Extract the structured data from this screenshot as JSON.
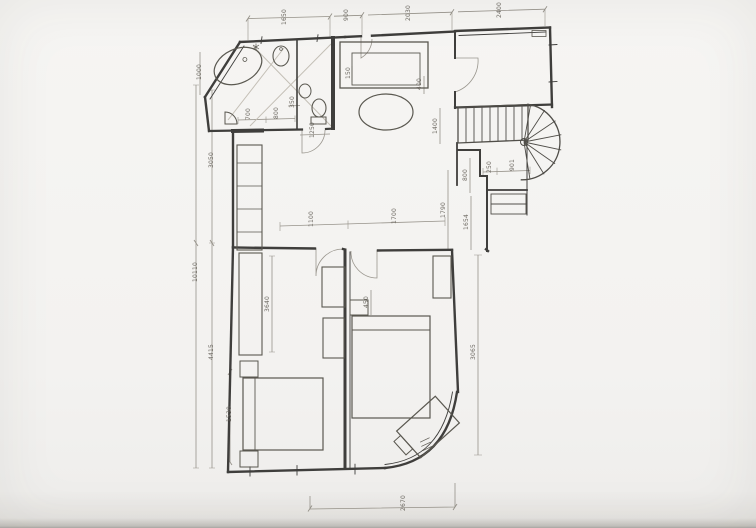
{
  "palette": {
    "paper": "#f5f4f2",
    "wall_line": "#3f3e3c",
    "furniture_line": "#5a5850",
    "dimension_line": "#97938b",
    "dimension_text": "#6e6a63",
    "light_construction": "#c7c2b8"
  },
  "fixtures": [
    "bathtub",
    "washbasin",
    "toilet",
    "corner-basin",
    "spiral-staircase",
    "straight-stairs",
    "dining-table",
    "kitchen-counter",
    "closet-shelves",
    "wardrobe",
    "bed",
    "nightstand",
    "dresser",
    "desk",
    "radiator"
  ],
  "dimensions": {
    "top_1": "1650",
    "top_2": "900",
    "top_3": "2030",
    "top_4": "2400",
    "left_outer": "10110",
    "left_in_1": "3050",
    "left_in_2": "4415",
    "left_in_3": "1530",
    "bath_1000": "1000",
    "bath_700": "700",
    "bath_800": "800",
    "bath_1250": "1250",
    "bath_350": "350",
    "mid_1100": "1100",
    "mid_1700": "1700",
    "bed_3640": "3640",
    "c_450": "450",
    "c_400": "400",
    "c_150": "150",
    "stair_1400": "1400",
    "stair_800": "800",
    "stair_1654": "1654",
    "stair_250": "250",
    "stair_901": "901",
    "right_1790": "1790",
    "right_3065": "3065",
    "bottom_2670": "2670"
  }
}
